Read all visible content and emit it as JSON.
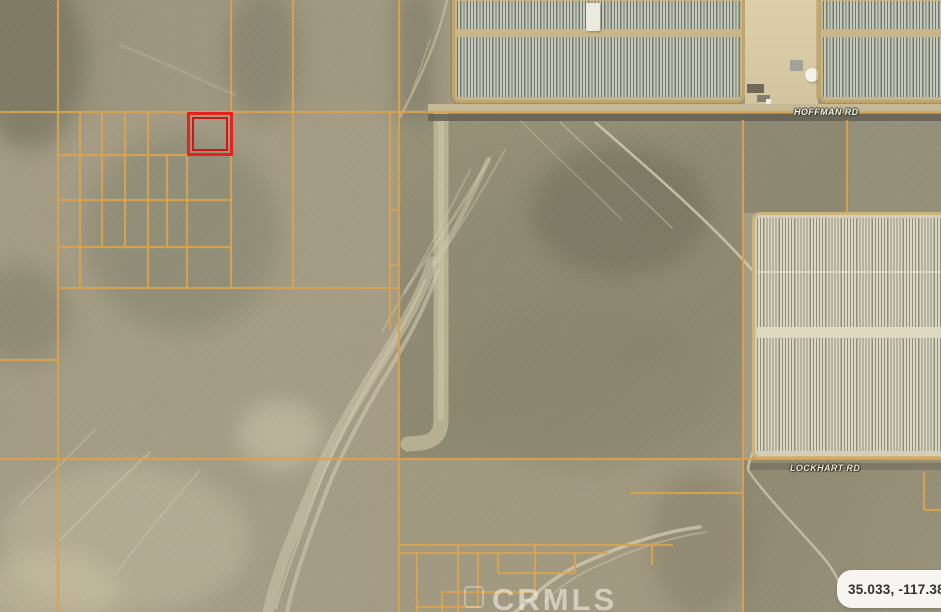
{
  "map": {
    "road_labels": {
      "hoffman": "HOFFMAN RD",
      "lockhart": "LOCKHART RD"
    },
    "watermark": "CRMLS",
    "coordinates_badge": "35.033, -117.383",
    "colors": {
      "parcel_line": "#d8a351",
      "subject_outline": "#e8211c",
      "terrain_base": "#a49c85",
      "road_label_text": "#f5f3ea",
      "badge_background": "#f6f5f1",
      "badge_text": "#303030"
    }
  }
}
